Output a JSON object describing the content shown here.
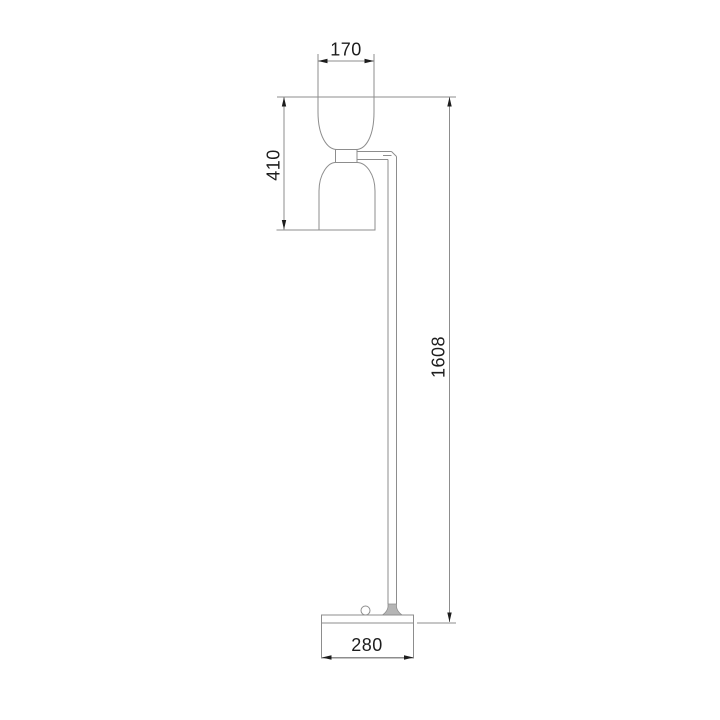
{
  "drawing": {
    "kind": "technical-dimension-drawing-floor-lamp",
    "dim_shade_width": "170",
    "dim_head_height": "410",
    "dim_total_height": "1608",
    "dim_base_width": "280"
  },
  "colors": {
    "background": "#ffffff",
    "outline": "#8d8d8d",
    "dimension_line": "#8d8d8d",
    "arrow_and_text": "#1d1d1d",
    "pole_foot_fill": "#b5b5b5"
  }
}
